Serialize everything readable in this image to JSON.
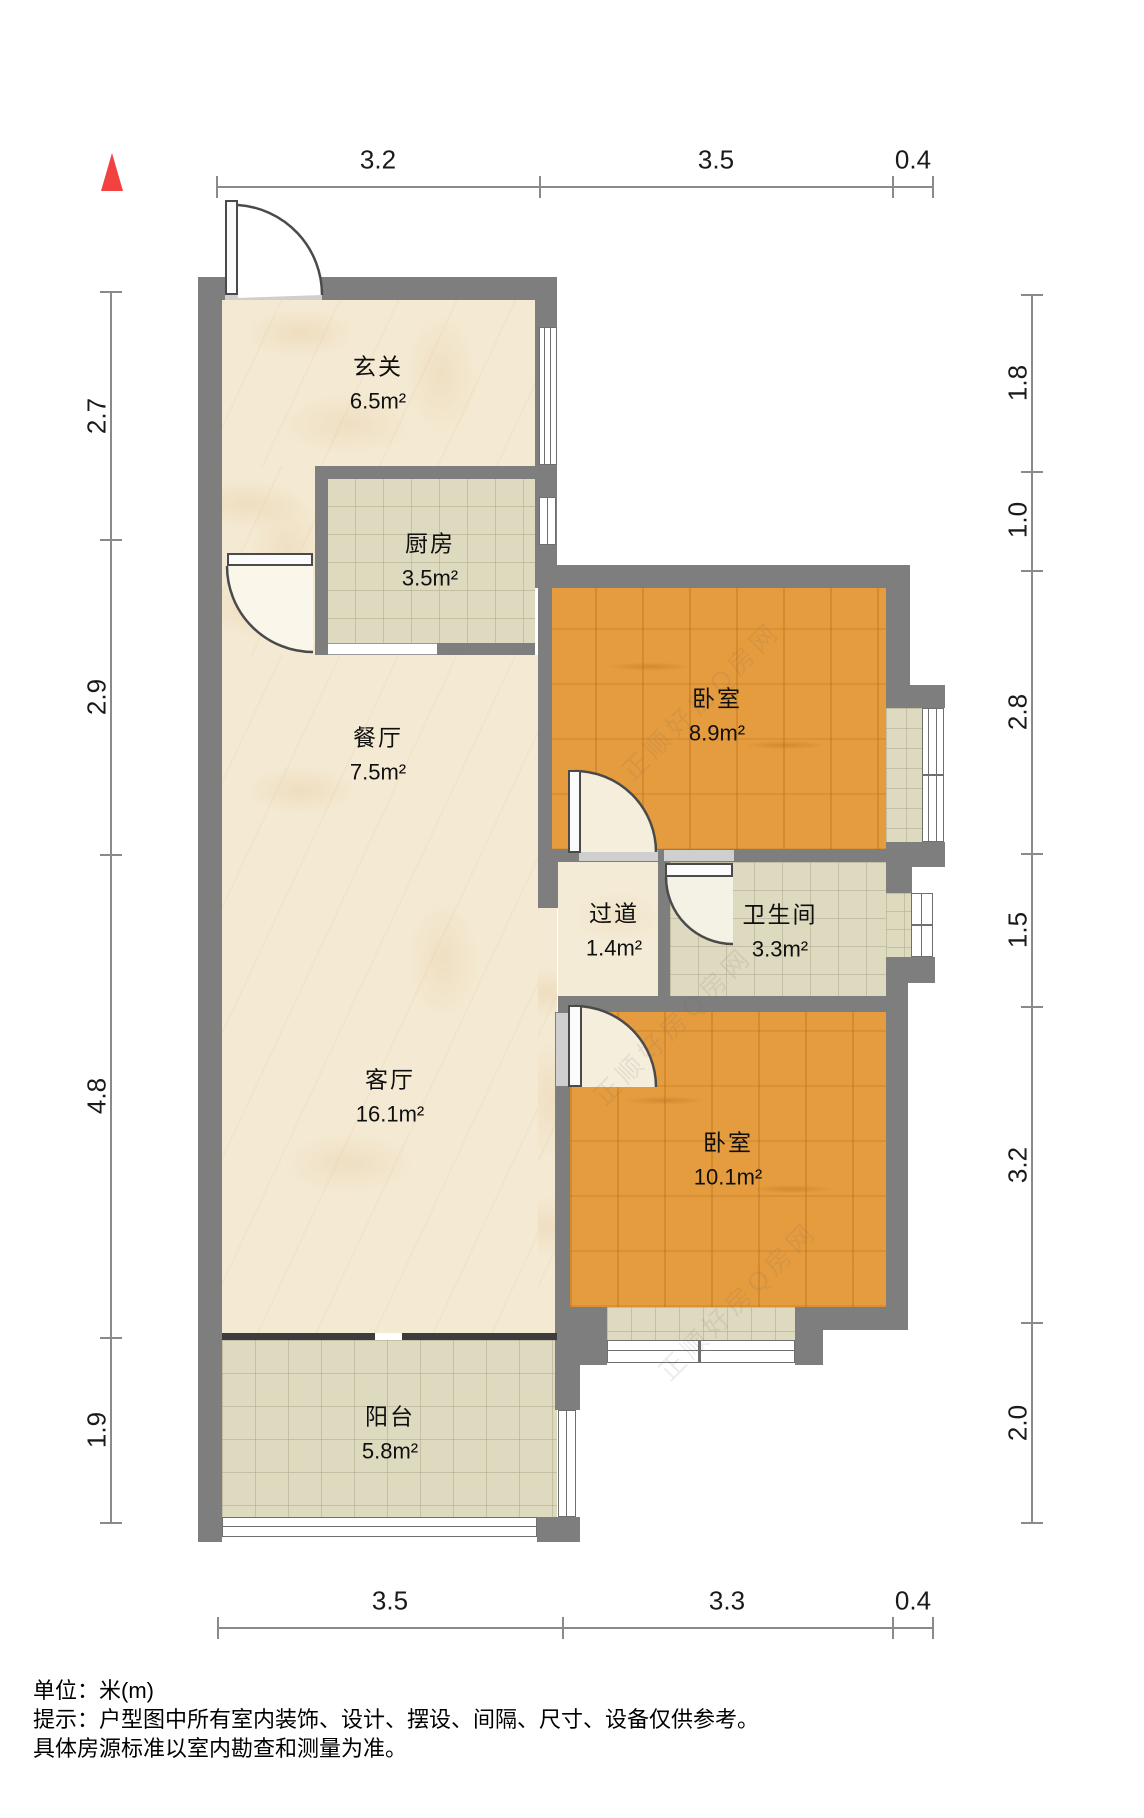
{
  "meta": {
    "type": "apartment floor plan",
    "unit_note": "单位：米(m)",
    "disclaimer_line1": "提示：户型图中所有室内装饰、设计、摆设、间隔、尺寸、设备仅供参考。",
    "disclaimer_line2": "具体房源标准以室内勘查和测量为准。",
    "watermark_text": "正顺好房Q房网"
  },
  "colors": {
    "wall": "#7e7e7e",
    "balcony_divider": "#3c3c3c",
    "wood_floor": "#e59c3e",
    "marble_floor": "#f4ead3",
    "tile_floor": "#dedac0",
    "north_arrow": "#f2413e",
    "dimension_line": "#8a8a8a"
  },
  "rooms": [
    {
      "name": "玄关",
      "area": "6.5m²"
    },
    {
      "name": "厨房",
      "area": "3.5m²"
    },
    {
      "name": "餐厅",
      "area": "7.5m²"
    },
    {
      "name": "卧室",
      "area": "8.9m²"
    },
    {
      "name": "过道",
      "area": "1.4m²"
    },
    {
      "name": "卫生间",
      "area": "3.3m²"
    },
    {
      "name": "客厅",
      "area": "16.1m²"
    },
    {
      "name": "卧室",
      "area": "10.1m²"
    },
    {
      "name": "阳台",
      "area": "5.8m²"
    }
  ],
  "dimensions": {
    "top": [
      {
        "value": "3.2"
      },
      {
        "value": "3.5"
      },
      {
        "value": "0.4"
      }
    ],
    "bottom": [
      {
        "value": "3.5"
      },
      {
        "value": "3.3"
      },
      {
        "value": "0.4"
      }
    ],
    "left": [
      {
        "value": "2.7"
      },
      {
        "value": "2.9"
      },
      {
        "value": "4.8"
      },
      {
        "value": "1.9"
      }
    ],
    "right": [
      {
        "value": "1.8"
      },
      {
        "value": "1.0"
      },
      {
        "value": "2.8"
      },
      {
        "value": "1.5"
      },
      {
        "value": "3.2"
      },
      {
        "value": "2.0"
      }
    ]
  }
}
